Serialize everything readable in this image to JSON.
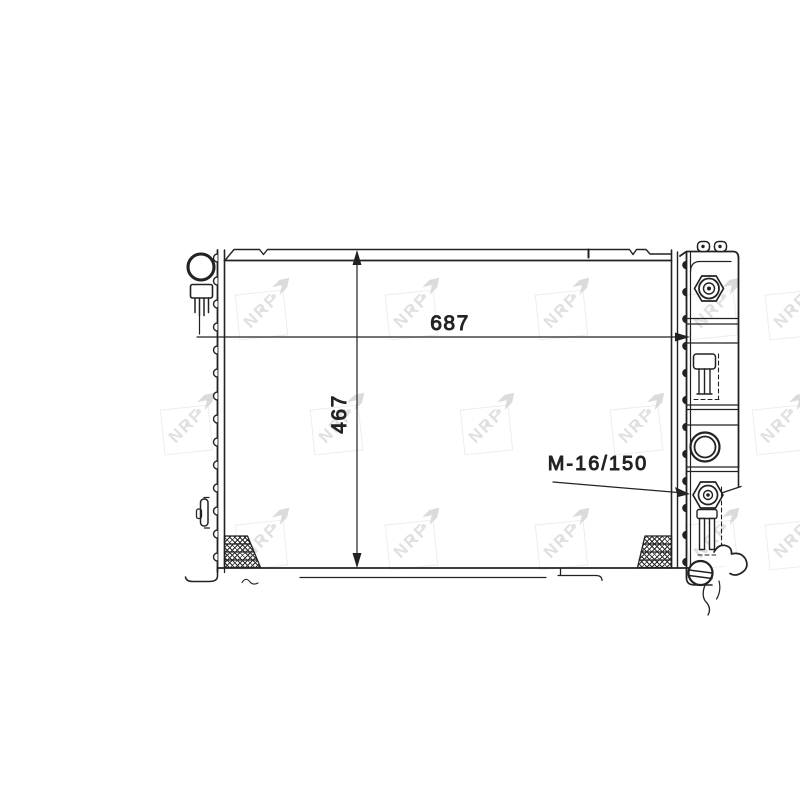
{
  "drawing": {
    "width_dimension_label": "687",
    "height_dimension_label": "467",
    "thread_spec_label": "M-16/150"
  },
  "watermark": {
    "label": "NRF"
  },
  "colors": {
    "line": "#222222",
    "background": "#ffffff",
    "watermark": "#e0e0e0"
  }
}
